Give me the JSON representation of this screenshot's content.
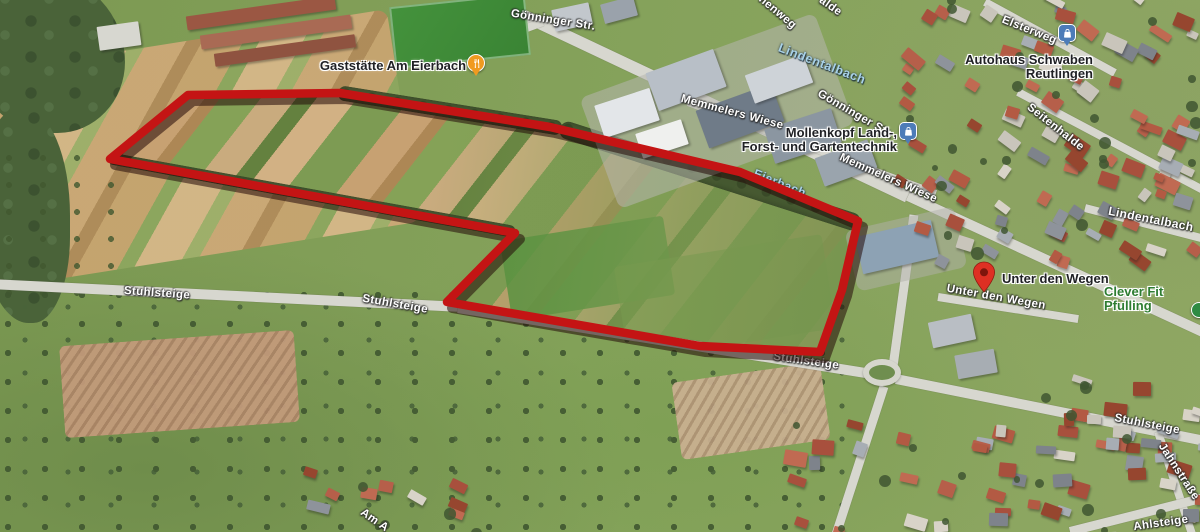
{
  "map": {
    "street_labels": [
      {
        "text": "Gönninger Str.",
        "x": 553,
        "y": 21,
        "rot": 9
      },
      {
        "text": "Elsterweg",
        "x": 1029,
        "y": 31,
        "rot": 22
      },
      {
        "text": "Memmelers Wiese",
        "x": 732,
        "y": 113,
        "rot": 15
      },
      {
        "text": "Gönninger Str.",
        "x": 855,
        "y": 115,
        "rot": 30
      },
      {
        "text": "Memmelers Wiese",
        "x": 888,
        "y": 179,
        "rot": 24
      },
      {
        "text": "Seitenhalde",
        "x": 1055,
        "y": 128,
        "rot": 38
      },
      {
        "text": "Lindentalbach",
        "x": 1151,
        "y": 219,
        "rot": 11,
        "size": 12
      },
      {
        "text": "Stuhlsteige",
        "x": 157,
        "y": 294,
        "rot": 4
      },
      {
        "text": "Stuhlsteige",
        "x": 395,
        "y": 305,
        "rot": 10
      },
      {
        "text": "Stuhlsteige",
        "x": 806,
        "y": 362,
        "rot": 8
      },
      {
        "text": "Stuhlsteige",
        "x": 1147,
        "y": 425,
        "rot": 11
      },
      {
        "text": "Unter den Wegen",
        "x": 996,
        "y": 298,
        "rot": 10
      },
      {
        "text": "Jahnstraße",
        "x": 1178,
        "y": 472,
        "rot": 57
      },
      {
        "text": "Ahlsteige",
        "x": 1161,
        "y": 524,
        "rot": -8
      },
      {
        "text": "Am A",
        "x": 374,
        "y": 521,
        "rot": 35
      },
      {
        "text": "nenweg",
        "x": 777,
        "y": 13,
        "rot": 40
      },
      {
        "text": "alde",
        "x": 830,
        "y": 7,
        "rot": 35
      }
    ],
    "water_labels": [
      {
        "text": "Lindentalbach",
        "x": 822,
        "y": 64,
        "rot": 21,
        "size": 12.5
      },
      {
        "text": "Eierbach",
        "x": 780,
        "y": 183,
        "rot": 22,
        "size": 12
      }
    ],
    "pois": [
      {
        "id": "gaststaette-am-eierbach",
        "lines": [
          "Gaststätte Am Eierbach"
        ],
        "x": 393,
        "y": 65,
        "align": "center",
        "color": "#202125"
      },
      {
        "id": "autohaus-schwaben-reutlingen",
        "lines": [
          "Autohaus Schwaben",
          "Reutlingen"
        ],
        "x": 1093,
        "y": 66,
        "align": "right",
        "color": "#202125"
      },
      {
        "id": "mollenkopf-land-forst-und-gartentechnik",
        "lines": [
          "Mollenkopf Land-,",
          "Forst- und Gartentechnik"
        ],
        "x": 897,
        "y": 139,
        "align": "right",
        "color": "#202125"
      },
      {
        "id": "unter-den-wegen",
        "lines": [
          "Unter den Wegen"
        ],
        "x": 1002,
        "y": 278,
        "align": "left",
        "color": "#202125"
      },
      {
        "id": "clever-fit-pfullingen",
        "lines": [
          "Clever Fit Pfulling"
        ],
        "x": 1104,
        "y": 291,
        "align": "left",
        "color": "#2e7d32"
      }
    ],
    "pins": [
      {
        "type": "restaurant",
        "x": 476,
        "y": 63,
        "color": "#f09a20"
      },
      {
        "type": "shopping",
        "x": 1067,
        "y": 33,
        "color": "#4d7cb8"
      },
      {
        "type": "shopping",
        "x": 908,
        "y": 131,
        "color": "#4d7cb8"
      },
      {
        "type": "place-marker",
        "x": 984,
        "y": 276,
        "color": "#de3023"
      },
      {
        "type": "green-dot",
        "x": 1199,
        "y": 310,
        "color": "#2e8b43"
      }
    ]
  },
  "annotation": {
    "type": "area-boundary",
    "stroke_color": "#c41414",
    "shadow_color": "rgba(35,10,8,0.55)",
    "points": [
      [
        110,
        159
      ],
      [
        188,
        95
      ],
      [
        340,
        93
      ],
      [
        550,
        127
      ],
      [
        740,
        172
      ],
      [
        858,
        221
      ],
      [
        842,
        290
      ],
      [
        820,
        352
      ],
      [
        700,
        346
      ],
      [
        447,
        302
      ],
      [
        515,
        233
      ]
    ]
  }
}
